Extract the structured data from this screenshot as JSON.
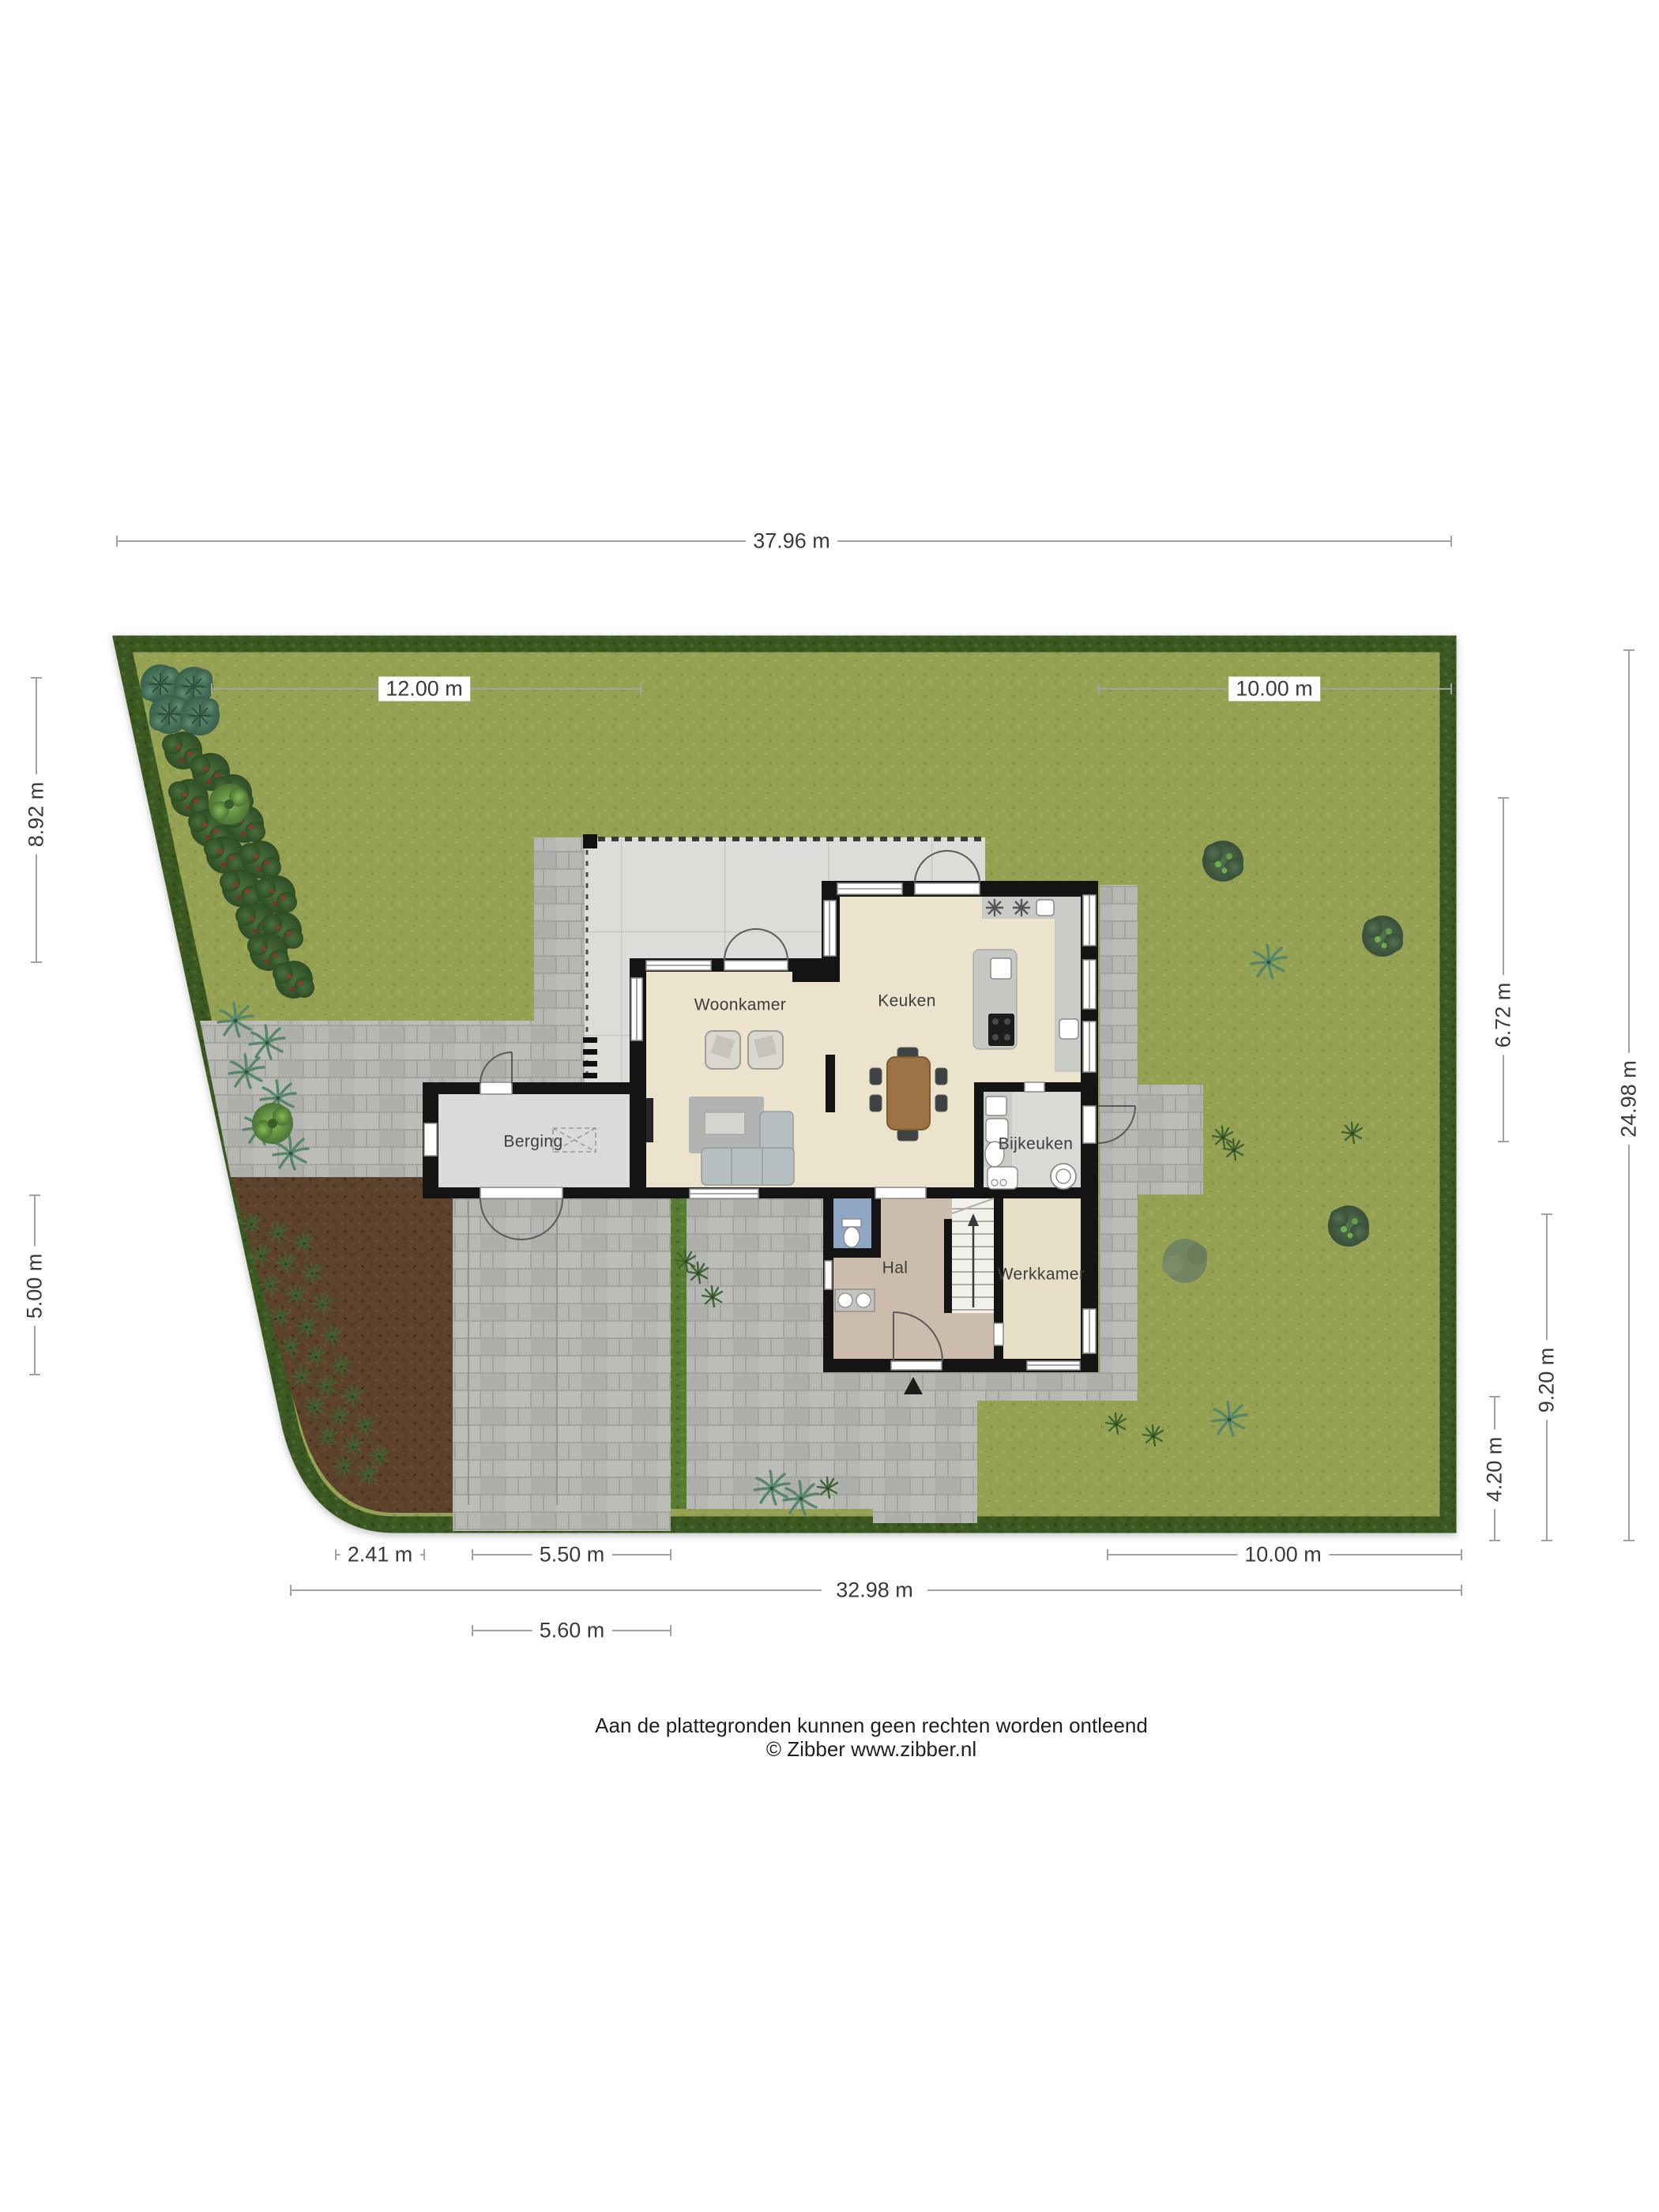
{
  "site_plan": {
    "rooms": {
      "woonkamer": "Woonkamer",
      "keuken": "Keuken",
      "bijkeuken": "Bijkeuken",
      "berging": "Berging",
      "hal": "Hal",
      "werkkamer": "Werkkamer"
    },
    "dimensions": {
      "top_total": "37.96 m",
      "top_left": "12.00 m",
      "top_right": "10.00 m",
      "left_upper": "8.92 m",
      "left_lower": "5.00 m",
      "right_upper": "6.72 m",
      "right_total": "24.98 m",
      "right_mid": "9.20 m",
      "right_lower": "4.20 m",
      "bottom_1": "2.41 m",
      "bottom_2": "5.50 m",
      "bottom_3": "10.00 m",
      "bottom_total": "32.98 m",
      "bottom_4": "5.60 m"
    },
    "footer": {
      "line1": "Aan de plattegronden kunnen geen rechten worden ontleend",
      "line2": "© Zibber www.zibber.nl"
    },
    "colors": {
      "lawn": "#96a252",
      "hedge": "#3b5922",
      "soil": "#5d432c",
      "paving": "#b6b7b3",
      "terrace": "#dcddd9",
      "floor_main": "#ebe3cb",
      "floor_hal": "#cbbcab",
      "floor_utility": "#d9d9d6",
      "floor_toilet": "#8fa6c4",
      "wall": "#141414",
      "wood": "#9b7345",
      "dimension_line": "#a2a2a2"
    }
  }
}
